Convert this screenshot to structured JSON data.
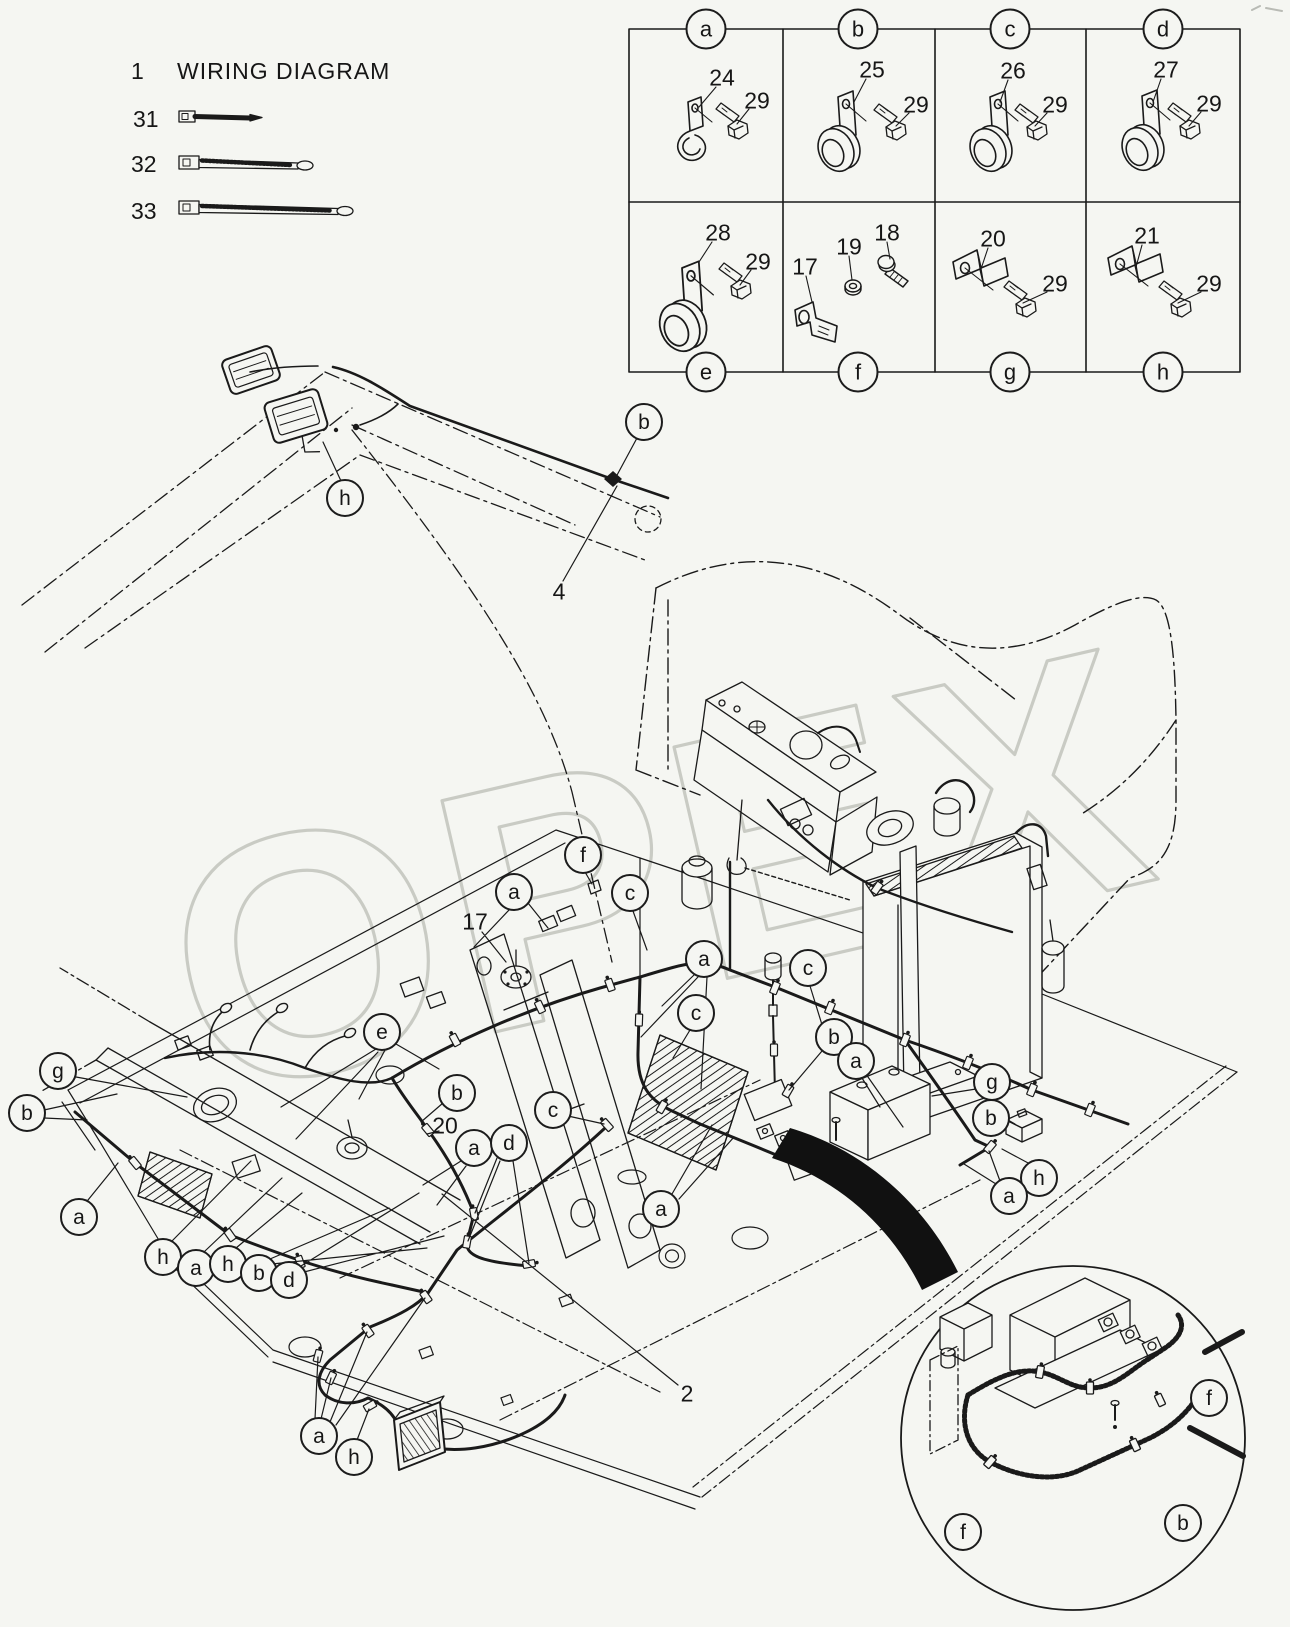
{
  "header": {
    "item_no": "1",
    "title": "WIRING DIAGRAM"
  },
  "legend": {
    "items": [
      {
        "ref": "31"
      },
      {
        "ref": "32"
      },
      {
        "ref": "33"
      }
    ]
  },
  "parts_grid": {
    "cells": [
      {
        "letter": "a",
        "parts": [
          {
            "ref": "24"
          },
          {
            "ref": "29"
          }
        ]
      },
      {
        "letter": "b",
        "parts": [
          {
            "ref": "25"
          },
          {
            "ref": "29"
          }
        ]
      },
      {
        "letter": "c",
        "parts": [
          {
            "ref": "26"
          },
          {
            "ref": "29"
          }
        ]
      },
      {
        "letter": "d",
        "parts": [
          {
            "ref": "27"
          },
          {
            "ref": "29"
          }
        ]
      },
      {
        "letter": "e",
        "parts": [
          {
            "ref": "28"
          },
          {
            "ref": "29"
          }
        ]
      },
      {
        "letter": "f",
        "parts": [
          {
            "ref": "17"
          },
          {
            "ref": "19"
          },
          {
            "ref": "18"
          }
        ]
      },
      {
        "letter": "g",
        "parts": [
          {
            "ref": "20"
          },
          {
            "ref": "29"
          }
        ]
      },
      {
        "letter": "h",
        "parts": [
          {
            "ref": "21"
          },
          {
            "ref": "29"
          }
        ]
      }
    ]
  },
  "diagram": {
    "ref_labels": [
      {
        "text": "4"
      },
      {
        "text": "17"
      },
      {
        "text": "20"
      },
      {
        "text": "2"
      }
    ],
    "callouts": [
      {
        "text": "h"
      },
      {
        "text": "b"
      },
      {
        "text": "f"
      },
      {
        "text": "a"
      },
      {
        "text": "c"
      },
      {
        "text": "a"
      },
      {
        "text": "c"
      },
      {
        "text": "c"
      },
      {
        "text": "b"
      },
      {
        "text": "a"
      },
      {
        "text": "e"
      },
      {
        "text": "g"
      },
      {
        "text": "b"
      },
      {
        "text": "a"
      },
      {
        "text": "h"
      },
      {
        "text": "a"
      },
      {
        "text": "h"
      },
      {
        "text": "b"
      },
      {
        "text": "d"
      },
      {
        "text": "b"
      },
      {
        "text": "a"
      },
      {
        "text": "d"
      },
      {
        "text": "c"
      },
      {
        "text": "a"
      },
      {
        "text": "g"
      },
      {
        "text": "b"
      },
      {
        "text": "h"
      },
      {
        "text": "a"
      },
      {
        "text": "a"
      },
      {
        "text": "h"
      },
      {
        "text": "f"
      },
      {
        "text": "f"
      },
      {
        "text": "b"
      }
    ]
  },
  "watermark": {
    "text": "OPEX"
  }
}
